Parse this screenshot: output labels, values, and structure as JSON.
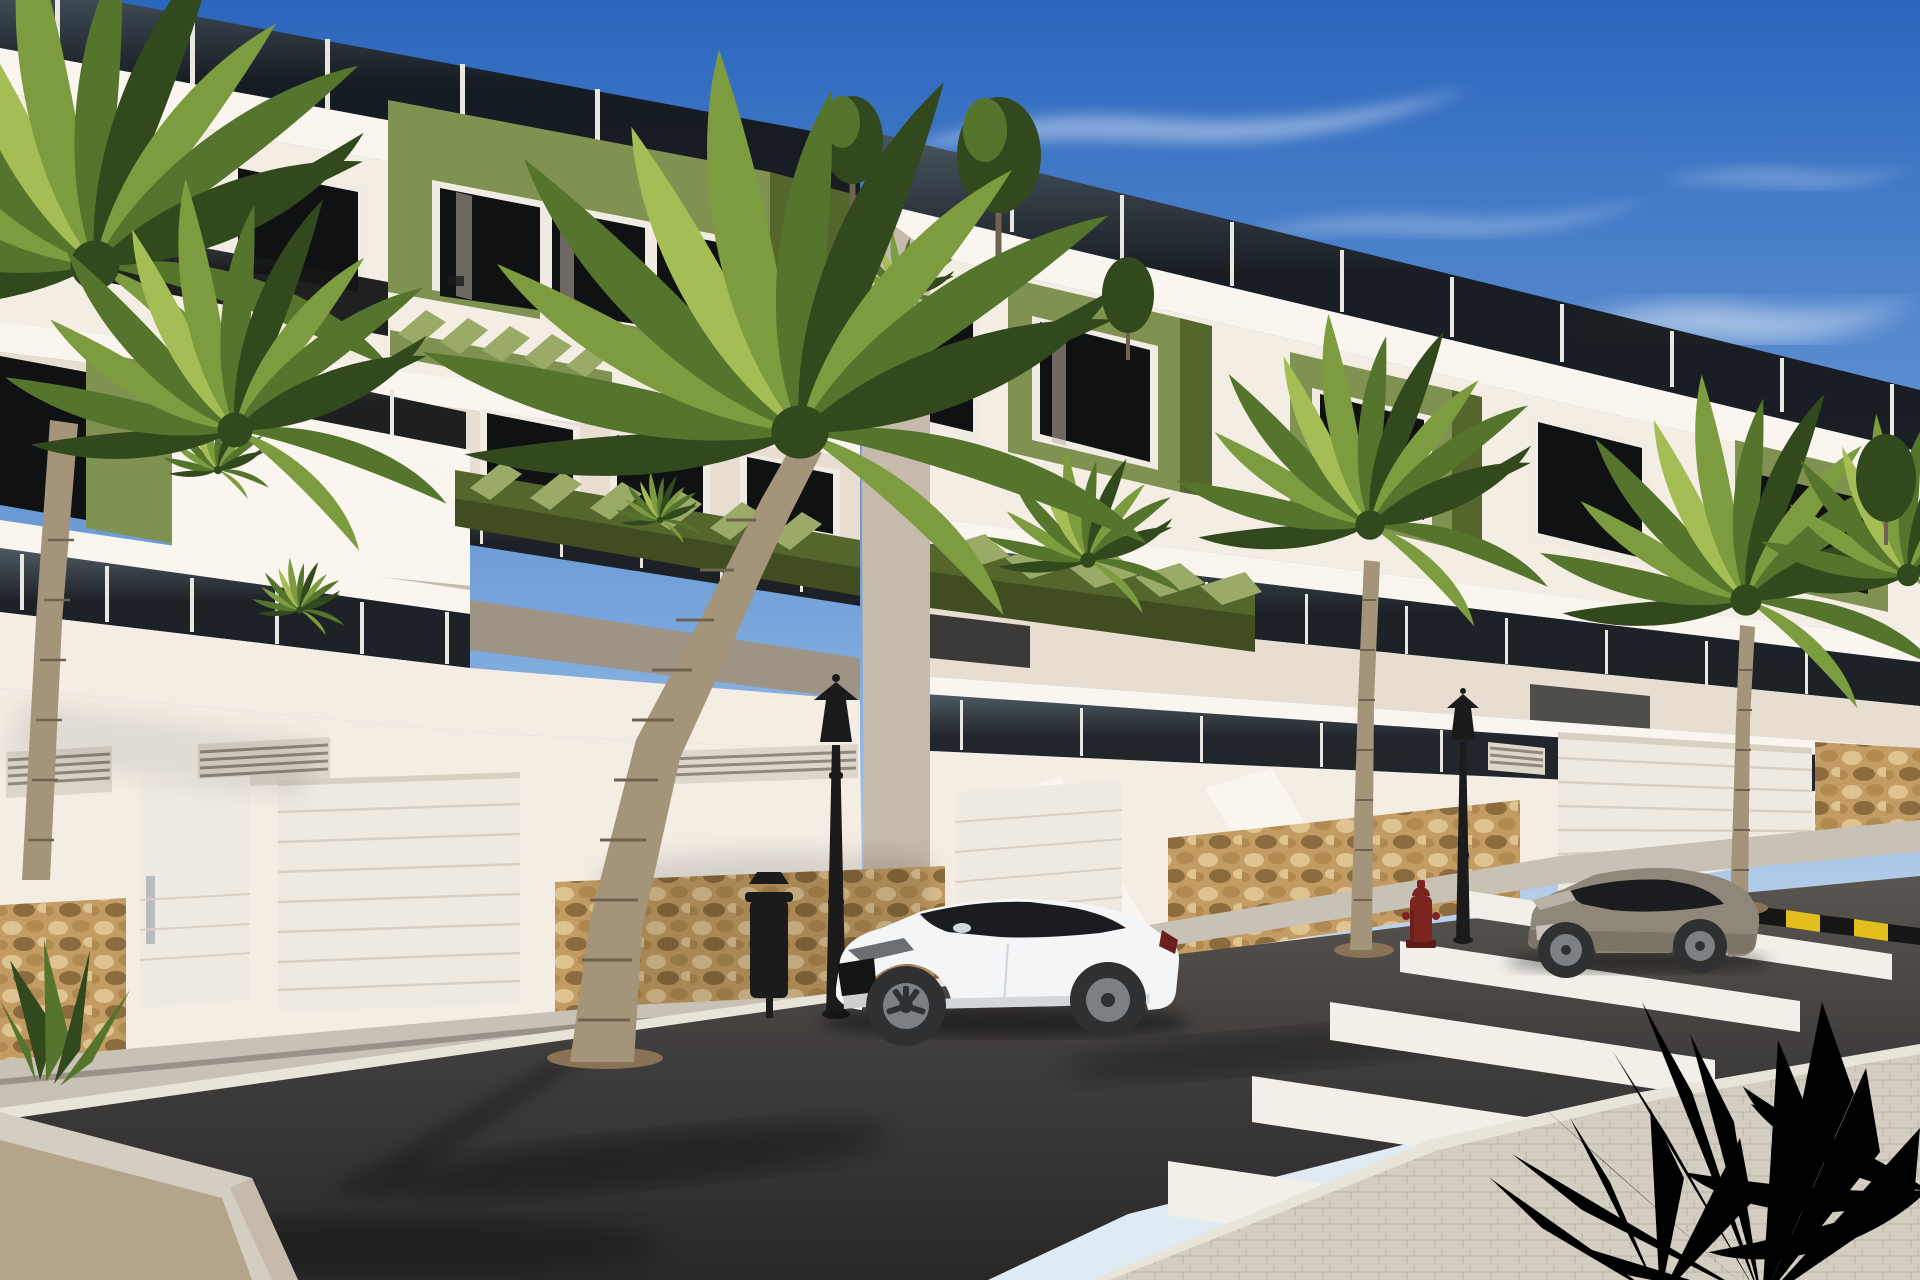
{
  "image": {
    "type": "3d-architectural-render",
    "description": "Street-level render of a modern three-storey apartment development: white facades with olive-green accent volumes, glass balcony balustrades, roof terraces with small trees, green pergolas, a street wall with natural-stone base, ventilation grilles and white garage doors. A white coupe and a grey coupe are parked along the kerb; classic black street lamps, a litter bin and a red fire hydrant stand on the pavement. A zebra crossing with a yellow-and-black kerb marking crosses the asphalt road; palm trees line the street and spiky fronds frame the lower-right corner under a blue sky with thin clouds."
  },
  "scene": {
    "canvas": {
      "width": 1920,
      "height": 1280
    },
    "objects": [
      {
        "name": "sky",
        "description": "Clear blue sky, lighter toward the horizon, with wispy cirrus clouds"
      },
      {
        "name": "apartment-block-left",
        "description": "Closer three-storey white block with olive-green feature box, dark glass balustrades, pergolas and roof terrace"
      },
      {
        "name": "apartment-block-right",
        "description": "Receding block with green window volumes, stepped terraces and rooftop railings"
      },
      {
        "name": "street-wall",
        "description": "White ground wall with rubble-stone base panels, vent grilles, pedestrian door and sectional garage doors"
      },
      {
        "name": "white-coupe",
        "description": "White two-door coupe parked facing left"
      },
      {
        "name": "gray-coupe",
        "description": "Grey two-door coupe parked further up the street facing left"
      },
      {
        "name": "street-lamp",
        "count": 2,
        "description": "Black classic lantern street lamps"
      },
      {
        "name": "litter-bin",
        "description": "Black cylindrical bin beside the nearest lamp"
      },
      {
        "name": "fire-hydrant",
        "description": "Dark red hydrant near the crossing"
      },
      {
        "name": "zebra-crossing",
        "description": "Five white stripes in perspective"
      },
      {
        "name": "kerb-marking",
        "description": "Yellow and black striped kerb edge right of the crossing"
      },
      {
        "name": "palm-trees",
        "count": 6,
        "description": "Large foreground palm, palms along the right pavement, fronds over the top-left corner"
      },
      {
        "name": "foreground-fronds",
        "description": "Bright spiky yucca fronds in the lower-right foreground"
      },
      {
        "name": "rooftop-trees",
        "count": 3,
        "description": "Small green trees on the roof terraces"
      },
      {
        "name": "agave",
        "description": "Small agave in the lower-left planter"
      }
    ]
  },
  "colors": {
    "sky_top": "#2b66bd",
    "sky_mid": "#7aa7dc",
    "sky_horizon": "#dfeaf3",
    "cloud": "#ffffff",
    "facade_white": "#f3ede4",
    "facade_bright": "#faf6ef",
    "facade_cream": "#e7ddd0",
    "facade_shadow": "#c5baab",
    "facade_deep_shadow": "#9d9486",
    "accent_green": "#7f9251",
    "accent_green_light": "#9aab67",
    "accent_green_dark": "#55662c",
    "accent_green_deep": "#3f4d20",
    "glass_dark": "#141617",
    "glass_light": "#4b5458",
    "post_white": "#e9e7e1",
    "window_dark": "#101112",
    "frame_white": "#f0ece3",
    "curtain": "#b9b2a4",
    "stone_base": "#c29c63",
    "stone_light": "#dfc391",
    "stone_mid": "#b08a50",
    "stone_dark": "#8c6c3e",
    "garage_door": "#efeae1",
    "door_shadow": "#d8d0c3",
    "vent_gray": "#ddd6cb",
    "vent_slat": "#8e887d",
    "sidewalk": "#c8c1b6",
    "sidewalk_bright": "#d4cdc2",
    "curb": "#e9e4da",
    "channel": "#8f8a82",
    "road_far": "#5a5550",
    "road_mid": "#3f3d3c",
    "road_near": "#292828",
    "zebra": "#f1efe8",
    "mark_yellow": "#e3bf1d",
    "mark_black": "#161616",
    "car_white": "#f4f5f6",
    "car_white_shade": "#d3d7da",
    "car_glass": "#1a1c1f",
    "car_gray": "#8f8779",
    "car_gray_shade": "#6e675c",
    "wheel": "#2e3032",
    "rim": "#7d8083",
    "hydrant": "#7c2520",
    "metal": "#1b1b1b",
    "palm_dark": "#32491d",
    "palm_mid": "#55742c",
    "palm_light": "#7d9c3f",
    "palm_bright": "#a5bd55",
    "trunk": "#a4947a",
    "trunk_dark": "#6f6250",
    "soil": "#8a7355",
    "gravel": "#b4a48c"
  }
}
